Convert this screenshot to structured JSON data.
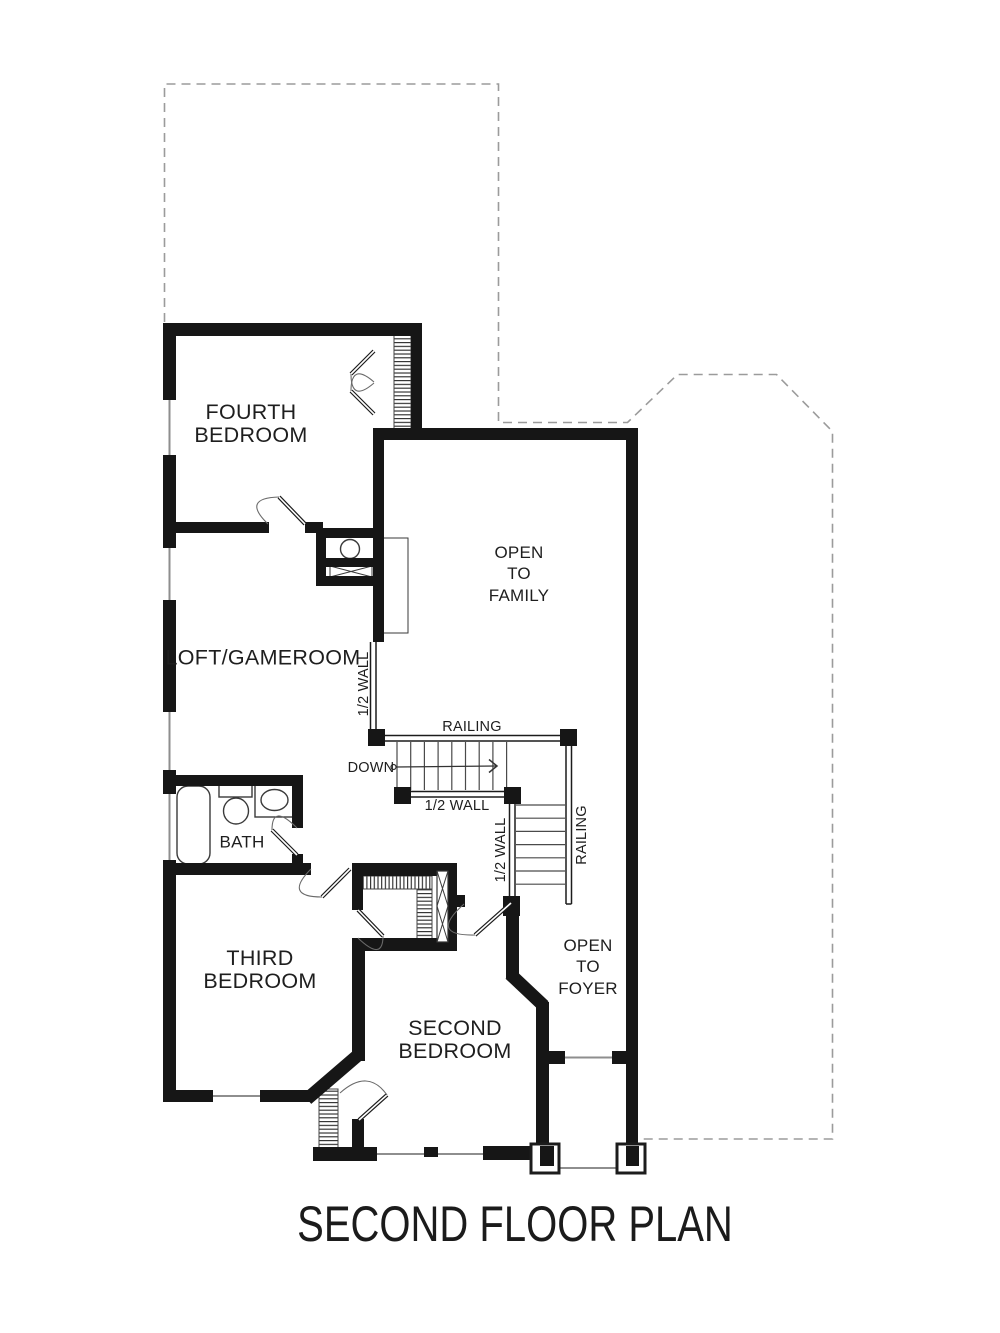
{
  "drawing": {
    "title": "SECOND FLOOR PLAN"
  },
  "labels": {
    "fourth_bedroom": "FOURTH\nBEDROOM",
    "loft_gameroom": "LOFT/GAMEROOM",
    "open_to_family": "OPEN\nTO\nFAMILY",
    "railing_top": "RAILING",
    "railing_right": "RAILING",
    "down": "DOWN",
    "half_wall_stair_bottom": "1/2 WALL",
    "half_wall_stair_side": "1/2 WALL",
    "half_wall_loft": "1/2 WALL",
    "bath": "BATH",
    "third_bedroom": "THIRD\nBEDROOM",
    "second_bedroom": "SECOND\nBEDROOM",
    "open_to_foyer": "OPEN\nTO\nFOYER"
  },
  "colors": {
    "wall": "#161616",
    "dashed_outline": "#9b9b9b",
    "thin_line": "#8e8e8e",
    "background": "#ffffff"
  }
}
